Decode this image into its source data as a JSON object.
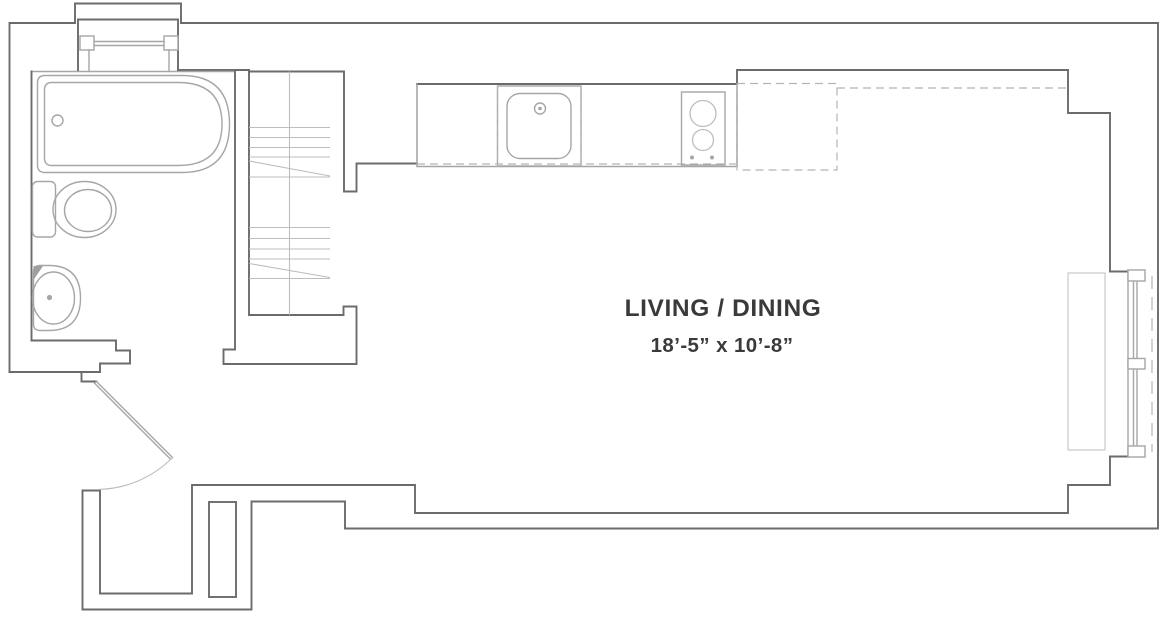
{
  "floorplan": {
    "labels": {
      "room": "LIVING / DINING",
      "dimensions": "18’-5” x 10’-8”"
    },
    "fixtures": [
      "bay-window",
      "bathtub",
      "toilet",
      "bathroom-sink",
      "entry-door",
      "closet-shelves",
      "kitchen-counter",
      "kitchen-sink",
      "cooktop",
      "refrigerator-dashed-outline",
      "east-window",
      "radiator"
    ],
    "colors": {
      "background": "#ffffff",
      "wall": "#6b6b6b",
      "fixture": "#a6a6a6",
      "light": "#bdbdbd",
      "dashed": "#b5b5b5",
      "ghost": "#c8c8c8",
      "text": "#3a3a3a"
    }
  }
}
